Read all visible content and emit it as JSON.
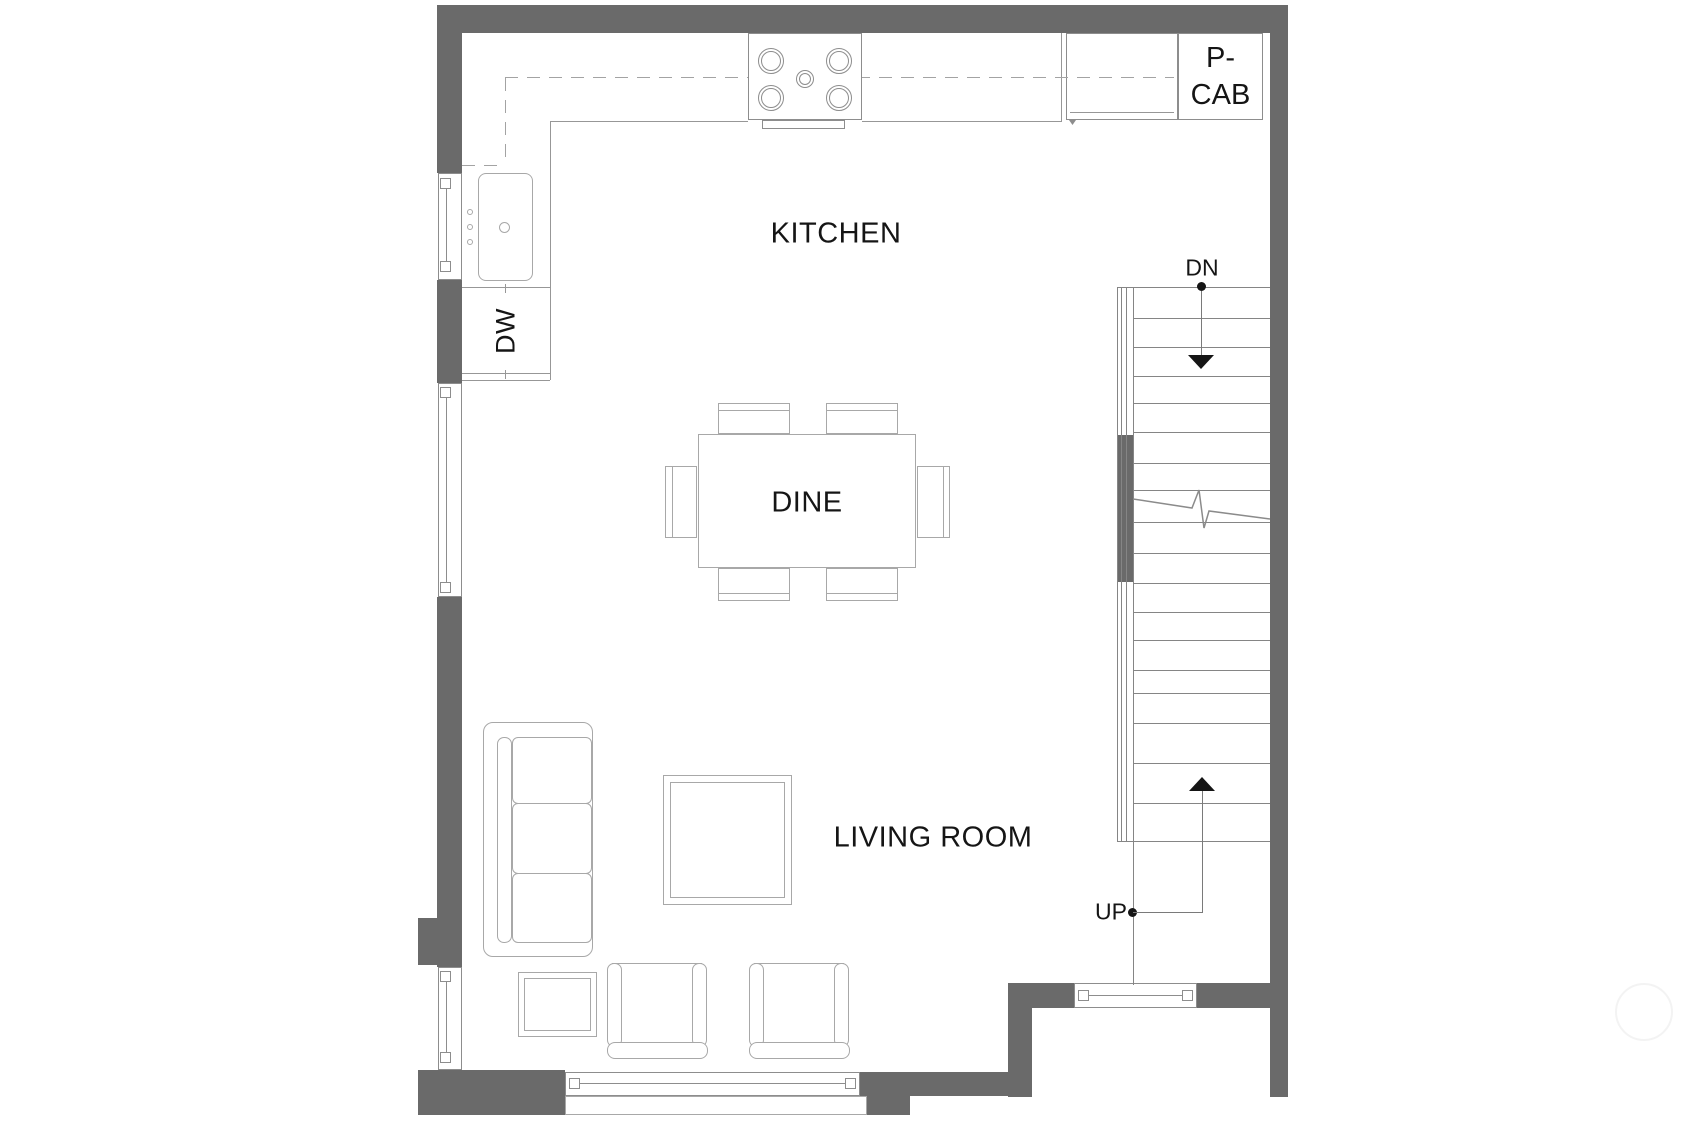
{
  "labels": {
    "kitchen": "KITCHEN",
    "dine": "DINE",
    "living_room": "LIVING ROOM",
    "dishwasher": "DW",
    "pantry_cabinet_line1": "P-",
    "pantry_cabinet_line2": "CAB",
    "stairs_down": "DN",
    "stairs_up": "UP"
  },
  "colors": {
    "wall": "#6a6a6a",
    "furniture_line": "#a8a8a8",
    "fixture_line": "#8d8d8d",
    "text": "#151515",
    "background": "#ffffff"
  },
  "fixtures": [
    "kitchen-sink",
    "cooktop-4-burner",
    "oven-handle",
    "refrigerator",
    "dishwasher",
    "pantry-cabinet",
    "upper-cabinet-dashed-line",
    "dining-table",
    "dining-chairs-x6",
    "sofa-3-seat",
    "coffee-table",
    "side-table",
    "armchair-x2",
    "staircase",
    "window-x5"
  ]
}
